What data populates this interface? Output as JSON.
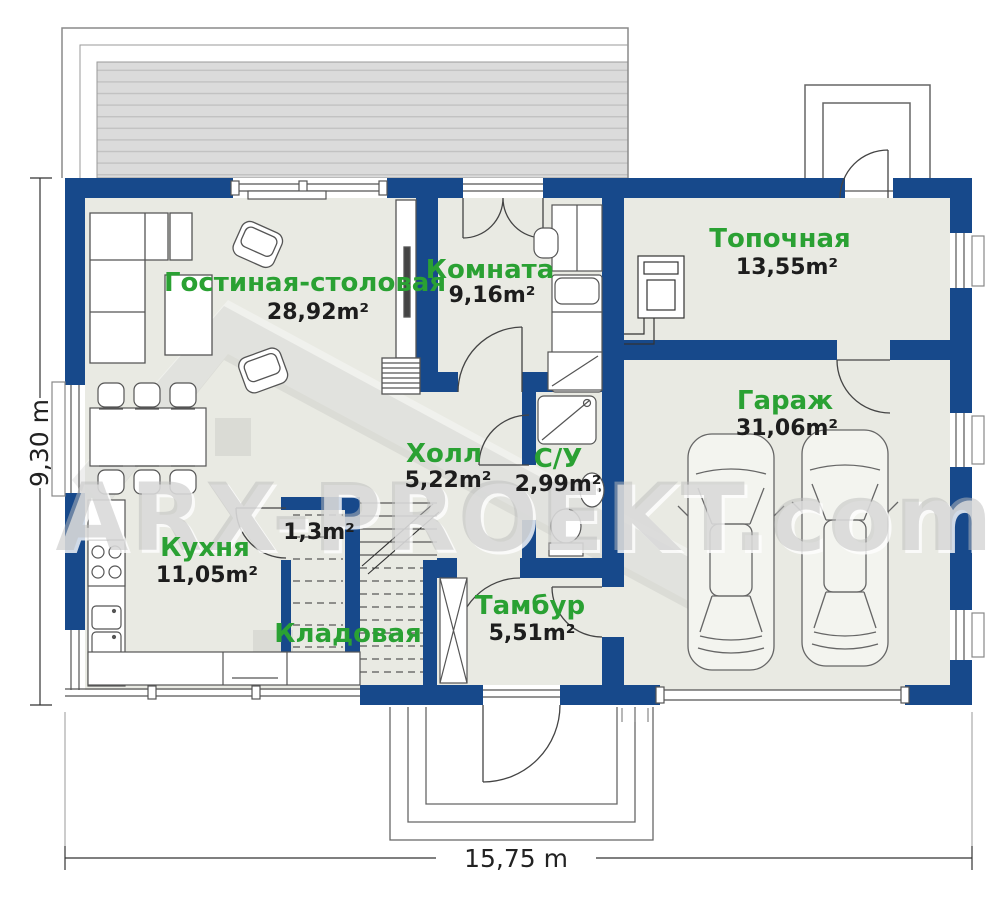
{
  "rooms": {
    "living": {
      "name": "Гостиная-столовая",
      "area": "28,92m²"
    },
    "bedroom": {
      "name": "Комната",
      "area": "9,16m²"
    },
    "boiler": {
      "name": "Топочная",
      "area": "13,55m²"
    },
    "garage": {
      "name": "Гараж",
      "area": "31,06m²"
    },
    "hall": {
      "name": "Холл",
      "area": "5,22m²"
    },
    "wc": {
      "name": "С/У",
      "area": "2,99m²"
    },
    "kitchen": {
      "name": "Кухня",
      "area": "11,05m²"
    },
    "closet": {
      "area": "1,3m²"
    },
    "storage": {
      "name": "Кладовая"
    },
    "vestibule": {
      "name": "Тамбур",
      "area": "5,51m²"
    }
  },
  "dimensions": {
    "width": "15,75 m",
    "height": "9,30 m"
  },
  "watermark": {
    "text": "ARX-PROEKT.com"
  },
  "colors": {
    "wall": "#17498b",
    "floor": "#e9eae3",
    "label_green": "#2aa133",
    "terrace": "#dbdbdb"
  }
}
